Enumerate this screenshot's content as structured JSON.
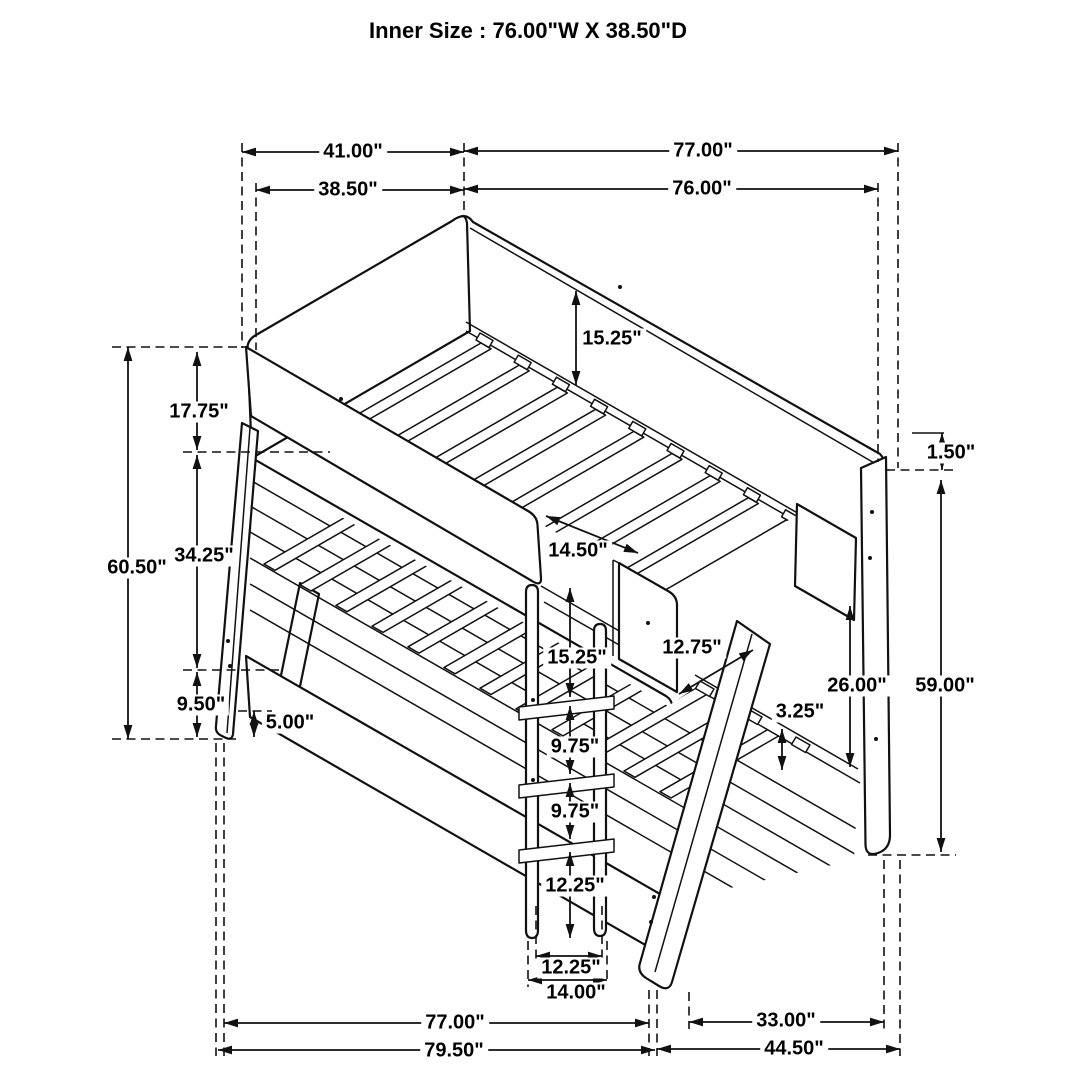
{
  "title": "Inner Size : 76.00\"W X  38.50\"D",
  "dims": {
    "top_41": "41.00\"",
    "top_77": "77.00\"",
    "top_38_5": "38.50\"",
    "top_76": "76.00\"",
    "rail_15_25": "15.25\"",
    "headboard_17_75": "17.75\"",
    "opening_14_50": "14.50\"",
    "left_34_25": "34.25\"",
    "left_60_50": "60.50\"",
    "ladder_15_25": "15.25\"",
    "opening_12_75": "12.75\"",
    "right_26_00": "26.00\"",
    "ladder_9_75_a": "9.75\"",
    "left_9_50": "9.50\"",
    "slat_3_25": "3.25\"",
    "right_59_00": "59.00\"",
    "left_5_00": "5.00\"",
    "ladder_9_75_b": "9.75\"",
    "ladder_12_25": "12.25\"",
    "right_1_50": "1.50\"",
    "ladder_width_12_25": "12.25\"",
    "ladder_width_14_00": "14.00\"",
    "bottom_77": "77.00\"",
    "bottom_33": "33.00\"",
    "bottom_79_5": "79.50\"",
    "bottom_44_5": "44.50\""
  }
}
